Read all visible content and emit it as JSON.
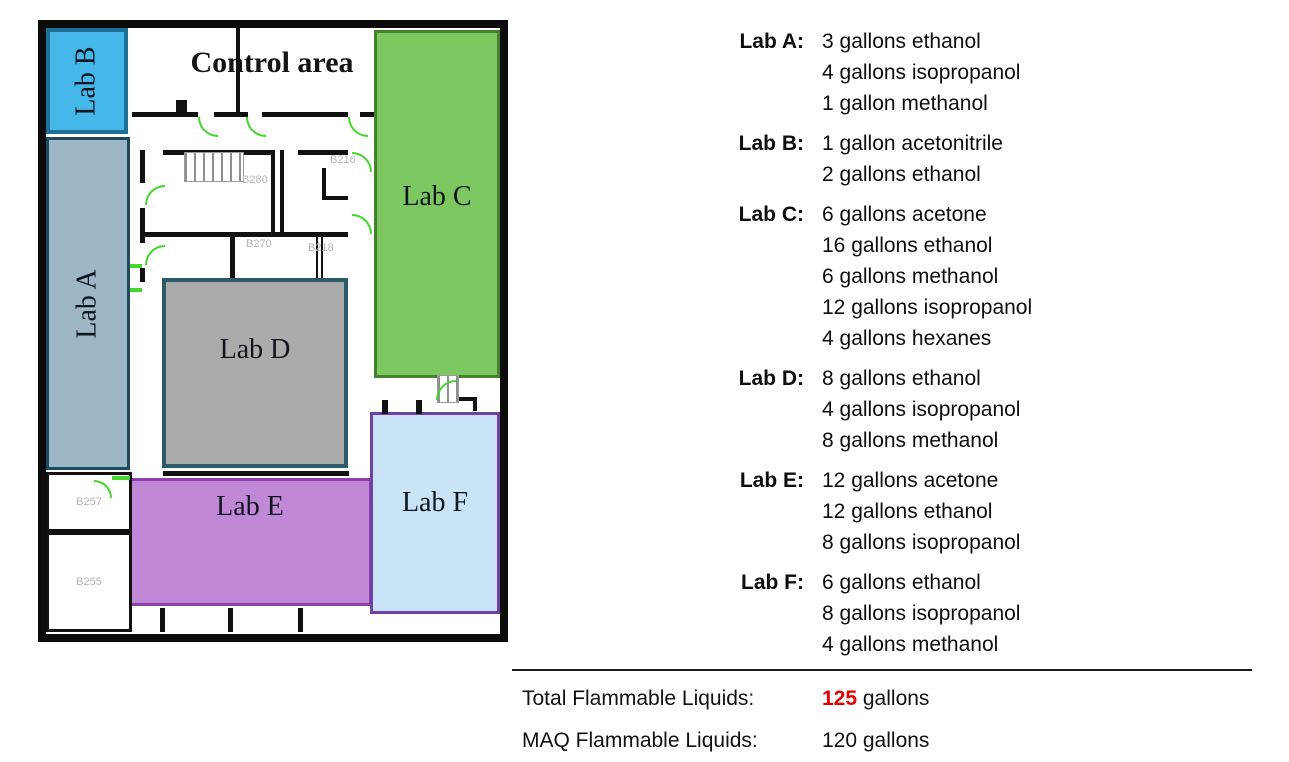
{
  "floorplan": {
    "control_area_label": "Control area",
    "rooms": {
      "labA": {
        "label": "Lab A",
        "fill": "#9db7c6",
        "border": "#1d4a5f"
      },
      "labB": {
        "label": "Lab B",
        "fill": "#45b7e8",
        "border": "#1e6f96"
      },
      "labC": {
        "label": "Lab C",
        "fill": "#7cc75f",
        "border": "#44822f"
      },
      "labD": {
        "label": "Lab D",
        "fill": "#ababab",
        "border": "#2c5a68"
      },
      "labE": {
        "label": "Lab E",
        "fill": "#c288d8",
        "border": "#8e3fae"
      },
      "labF": {
        "label": "Lab F",
        "fill": "#c9e3f6",
        "border": "#6f40a5"
      }
    },
    "room_numbers": {
      "r1": "B280",
      "r2": "B216",
      "r3": "B270",
      "r4": "B218",
      "r5": "B257",
      "r6": "B255"
    }
  },
  "inventory": {
    "sections": [
      {
        "label": "Lab A:",
        "items": [
          "3 gallons ethanol",
          "4 gallons isopropanol",
          "1 gallon methanol"
        ]
      },
      {
        "label": "Lab B:",
        "items": [
          "1 gallon acetonitrile",
          "2 gallons ethanol"
        ]
      },
      {
        "label": "Lab C:",
        "items": [
          "6 gallons acetone",
          "16 gallons ethanol",
          "6 gallons methanol",
          "12 gallons isopropanol",
          "4 gallons hexanes"
        ]
      },
      {
        "label": "Lab D:",
        "items": [
          "8 gallons ethanol",
          "4 gallons isopropanol",
          "8 gallons methanol"
        ]
      },
      {
        "label": "Lab E:",
        "items": [
          "12 gallons acetone",
          "12 gallons ethanol",
          "8 gallons isopropanol"
        ]
      },
      {
        "label": "Lab F:",
        "items": [
          "6 gallons ethanol",
          "8 gallons isopropanol",
          "4 gallons methanol"
        ]
      }
    ],
    "totals": [
      {
        "label": "Total Flammable Liquids:",
        "value": "125",
        "unit": " gallons"
      },
      {
        "label": "MAQ Flammable Liquids:",
        "value": "120",
        "unit": " gallons"
      }
    ]
  },
  "colors": {
    "total_highlight": "#e30000",
    "door_swing_green": "#44d62c"
  }
}
